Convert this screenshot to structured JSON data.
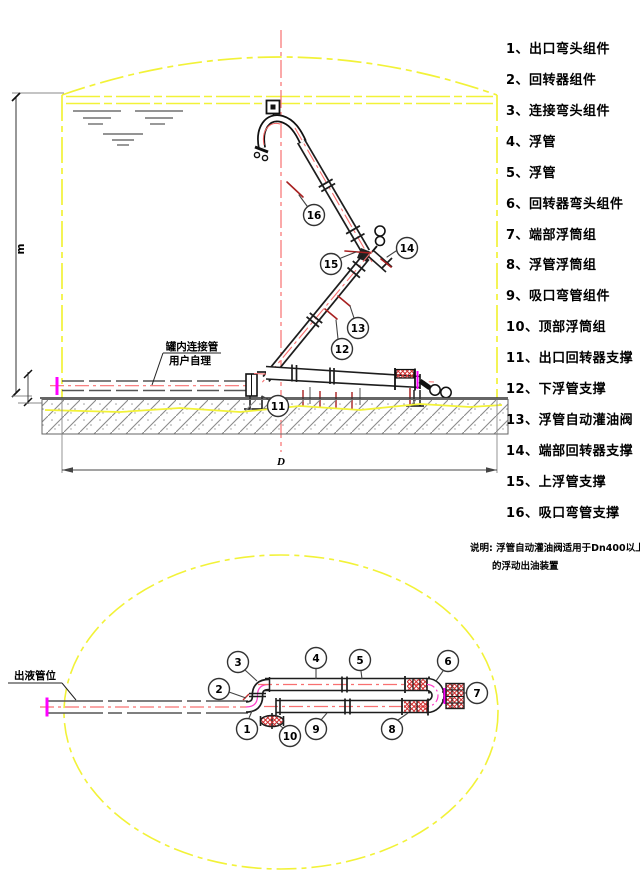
{
  "legend": {
    "items": [
      "1、出口弯头组件",
      "2、回转器组件",
      "3、连接弯头组件",
      "4、浮管",
      "5、浮管",
      "6、回转器弯头组件",
      "7、端部浮筒组",
      "8、浮管浮筒组",
      "9、吸口弯管组件",
      "10、顶部浮筒组",
      "11、出口回转器支撑",
      "12、下浮管支撑",
      "13、浮管自动灌油阀",
      "14、端部回转器支撑",
      "15、上浮管支撑",
      "16、吸口弯管支撑"
    ]
  },
  "note": {
    "line1": "说明: 浮管自动灌油阀适用于Dn400以上",
    "line2": "的浮动出油装置"
  },
  "elevation": {
    "pipe_label_line1": "罐内连接管",
    "pipe_label_line2": "用户自理",
    "height_dim_label": "m",
    "diameter_dim_label": "D",
    "callouts": [
      "16",
      "15",
      "14",
      "13",
      "12",
      "11"
    ]
  },
  "plan": {
    "outlet_label": "出液管位",
    "callouts": [
      "1",
      "2",
      "3",
      "4",
      "5",
      "6",
      "7",
      "8",
      "9",
      "10"
    ]
  },
  "colors": {
    "tank_outline_yellow": "#f2f238",
    "centerline_red": "#f87070",
    "leader_dark_red": "#a82020",
    "flange_magenta": "#ff00ff",
    "elbow_arc_pink": "#ff3dc8",
    "pipe_black": "#1d1d1d",
    "float_hatch_red": "#d03030",
    "background": "#ffffff"
  }
}
